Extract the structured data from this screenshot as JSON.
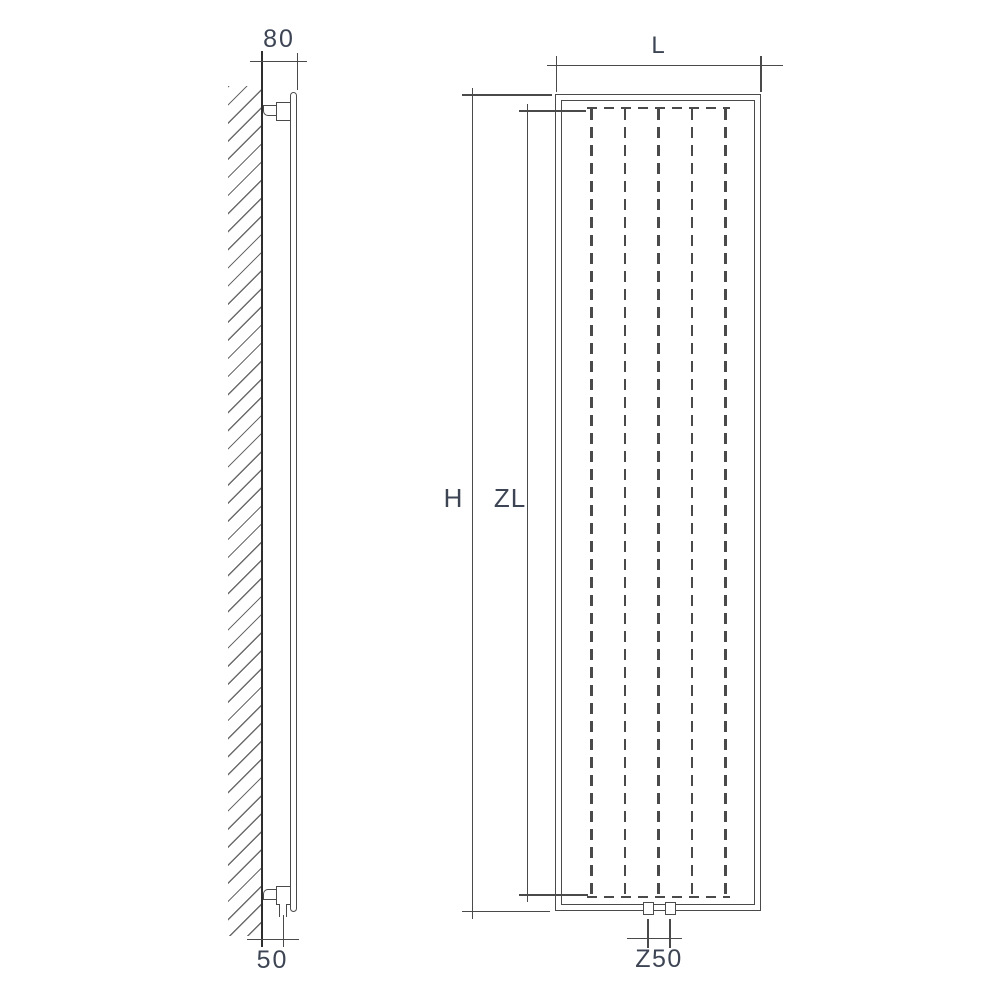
{
  "diagram": {
    "type": "technical-drawing",
    "subject": "vertical panel radiator, wall mounted — side view and front view with dimension lines",
    "side_view": {
      "dim_wall_to_front": {
        "label": "80"
      },
      "dim_wall_to_connection": {
        "label": "50"
      }
    },
    "front_view": {
      "dim_width": {
        "label": "L"
      },
      "dim_height": {
        "label": "H"
      },
      "dim_element_height": {
        "label": "ZL"
      },
      "dim_connection_spacing": {
        "label": "Z50"
      }
    },
    "fin_lines_count": 5,
    "connections_count": 2,
    "colors": {
      "line": "#4a4a4a",
      "wall_line": "#2e2e2e",
      "hatch": "#6b6b6b",
      "text": "#3d4454",
      "background": "#ffffff"
    }
  }
}
